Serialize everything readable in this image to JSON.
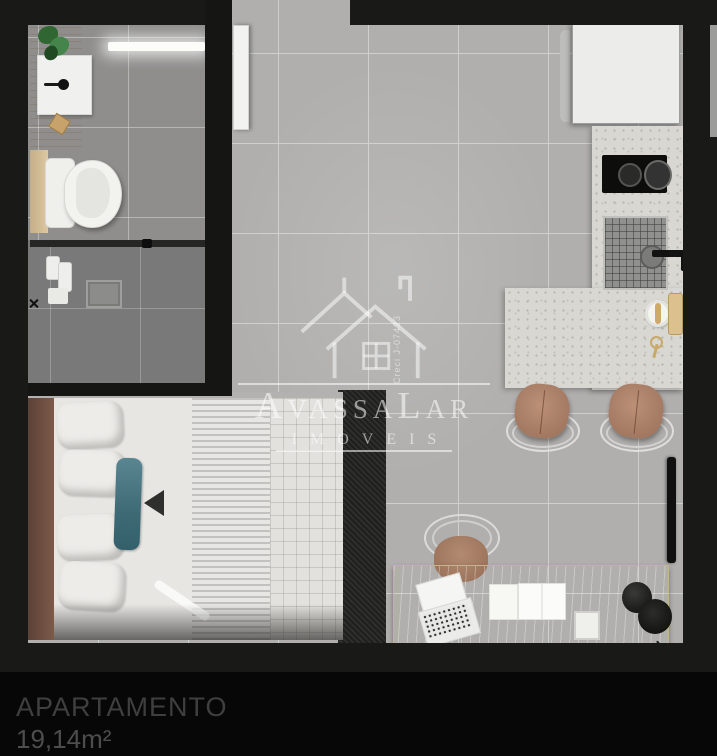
{
  "caption": {
    "name": "APARTAMENTO",
    "area": "19,14m²"
  },
  "watermark": {
    "brand": "AvassaLar",
    "subtitle": "IMOVEIS",
    "license": "Creci J-07423"
  },
  "colors": {
    "background": "#060606",
    "wall": "#191917",
    "floor": "#b0afae",
    "grout": "#cfcfcd",
    "floor_bath": "#8f8e8d",
    "floor_shower": "#7a7979",
    "counter": "#d8d7d2",
    "desk_wood": "#dcc9a2",
    "teal": "#38636e",
    "leather": "#a97e68",
    "accent_blue": "#82aaef",
    "watermark_white": "rgba(255,255,255,0.55)",
    "caption_text": "#3f3f3f",
    "caption_area": "#4d4d4d"
  }
}
